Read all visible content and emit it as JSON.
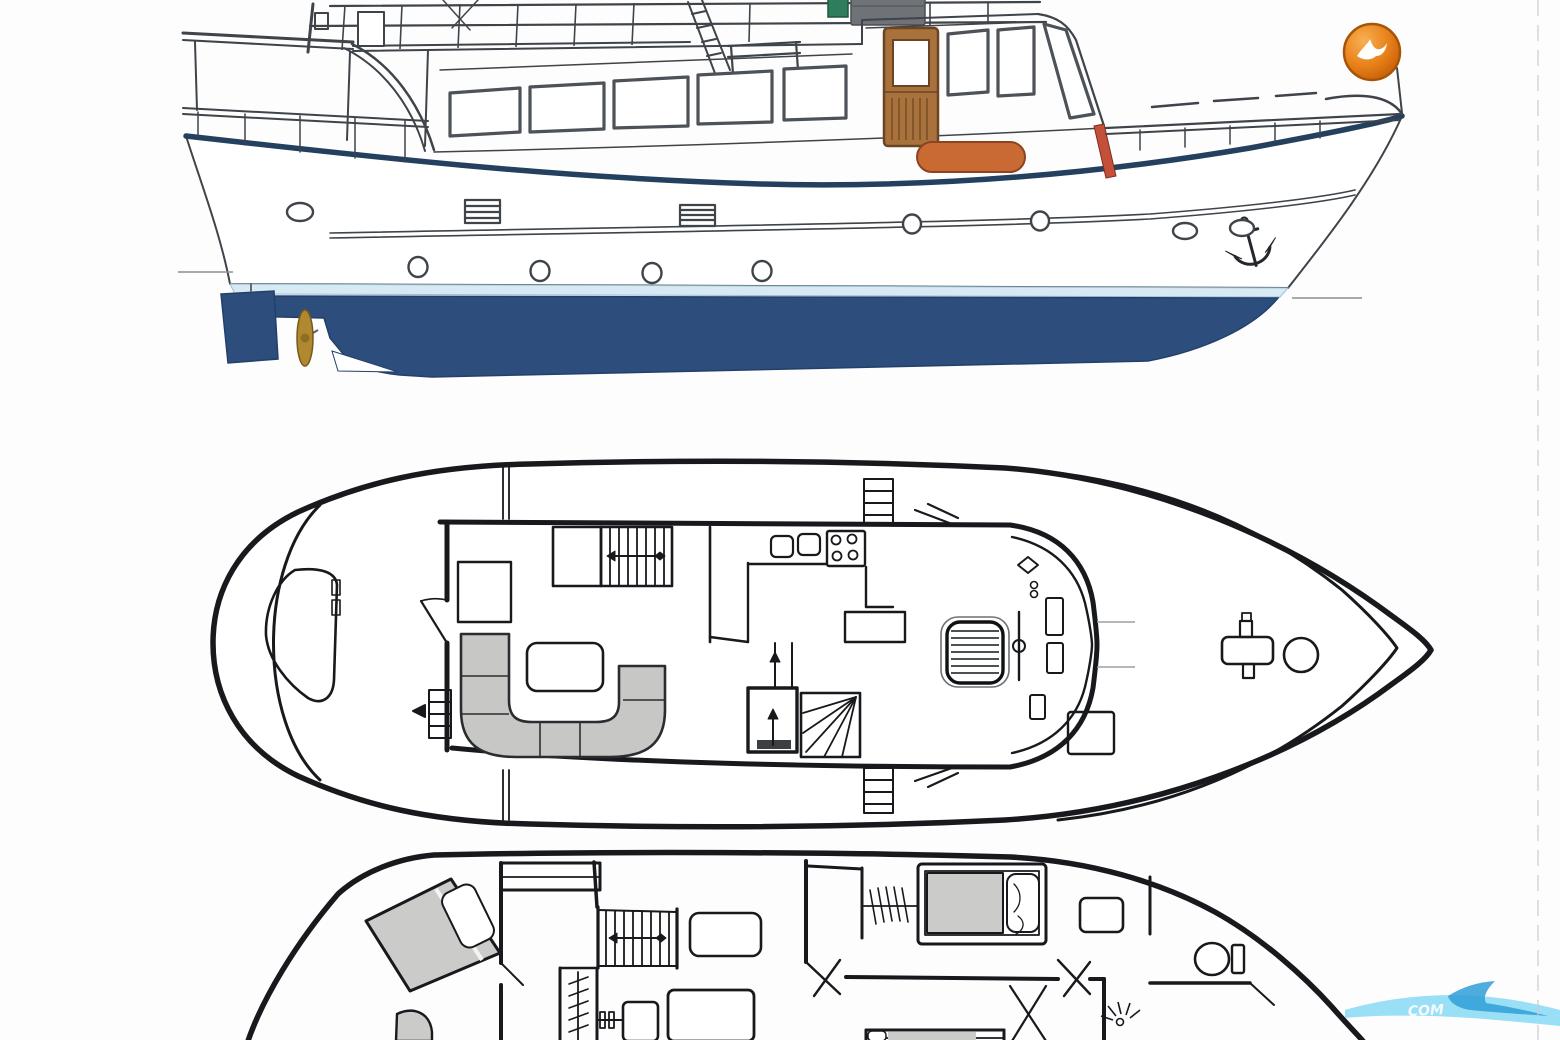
{
  "page": {
    "background": "#fdfdfd",
    "scan_edge_color": "#c9ccd0"
  },
  "branding": {
    "logo_badge": {
      "icon": "gull-icon",
      "ring_color": "#a85405",
      "fill_top": "#f8b054",
      "fill_mid": "#e8821a",
      "fill_bottom": "#c35b06",
      "gull_color": "#ffffff"
    },
    "watermark": {
      "visible_text": "COM",
      "wave_light": "#8edcf4",
      "wave_dark": "#2f9fd8",
      "text_color": "#ffffff"
    }
  },
  "drawing": {
    "subject": "motor-yacht general arrangement",
    "views": [
      {
        "id": "side-profile"
      },
      {
        "id": "main-deck-plan"
      },
      {
        "id": "lower-deck-plan"
      }
    ],
    "colors": {
      "outline": "#3f444a",
      "plan_line": "#17191c",
      "hull_bottom": "#2d4d7c",
      "sheer_stripe": "#23405f",
      "boot_stripe": "#d7e9f3",
      "door_wood": "#a9713c",
      "door_trim": "#6b4423",
      "liferaft": "#c96a35",
      "mast_red": "#c4503a",
      "flybridge_green": "#2e7d5b",
      "console_gray": "#6f7377",
      "propeller": "#b08830",
      "upholstery": "#c7c7c5",
      "mattress": "#cbcbc9"
    }
  }
}
